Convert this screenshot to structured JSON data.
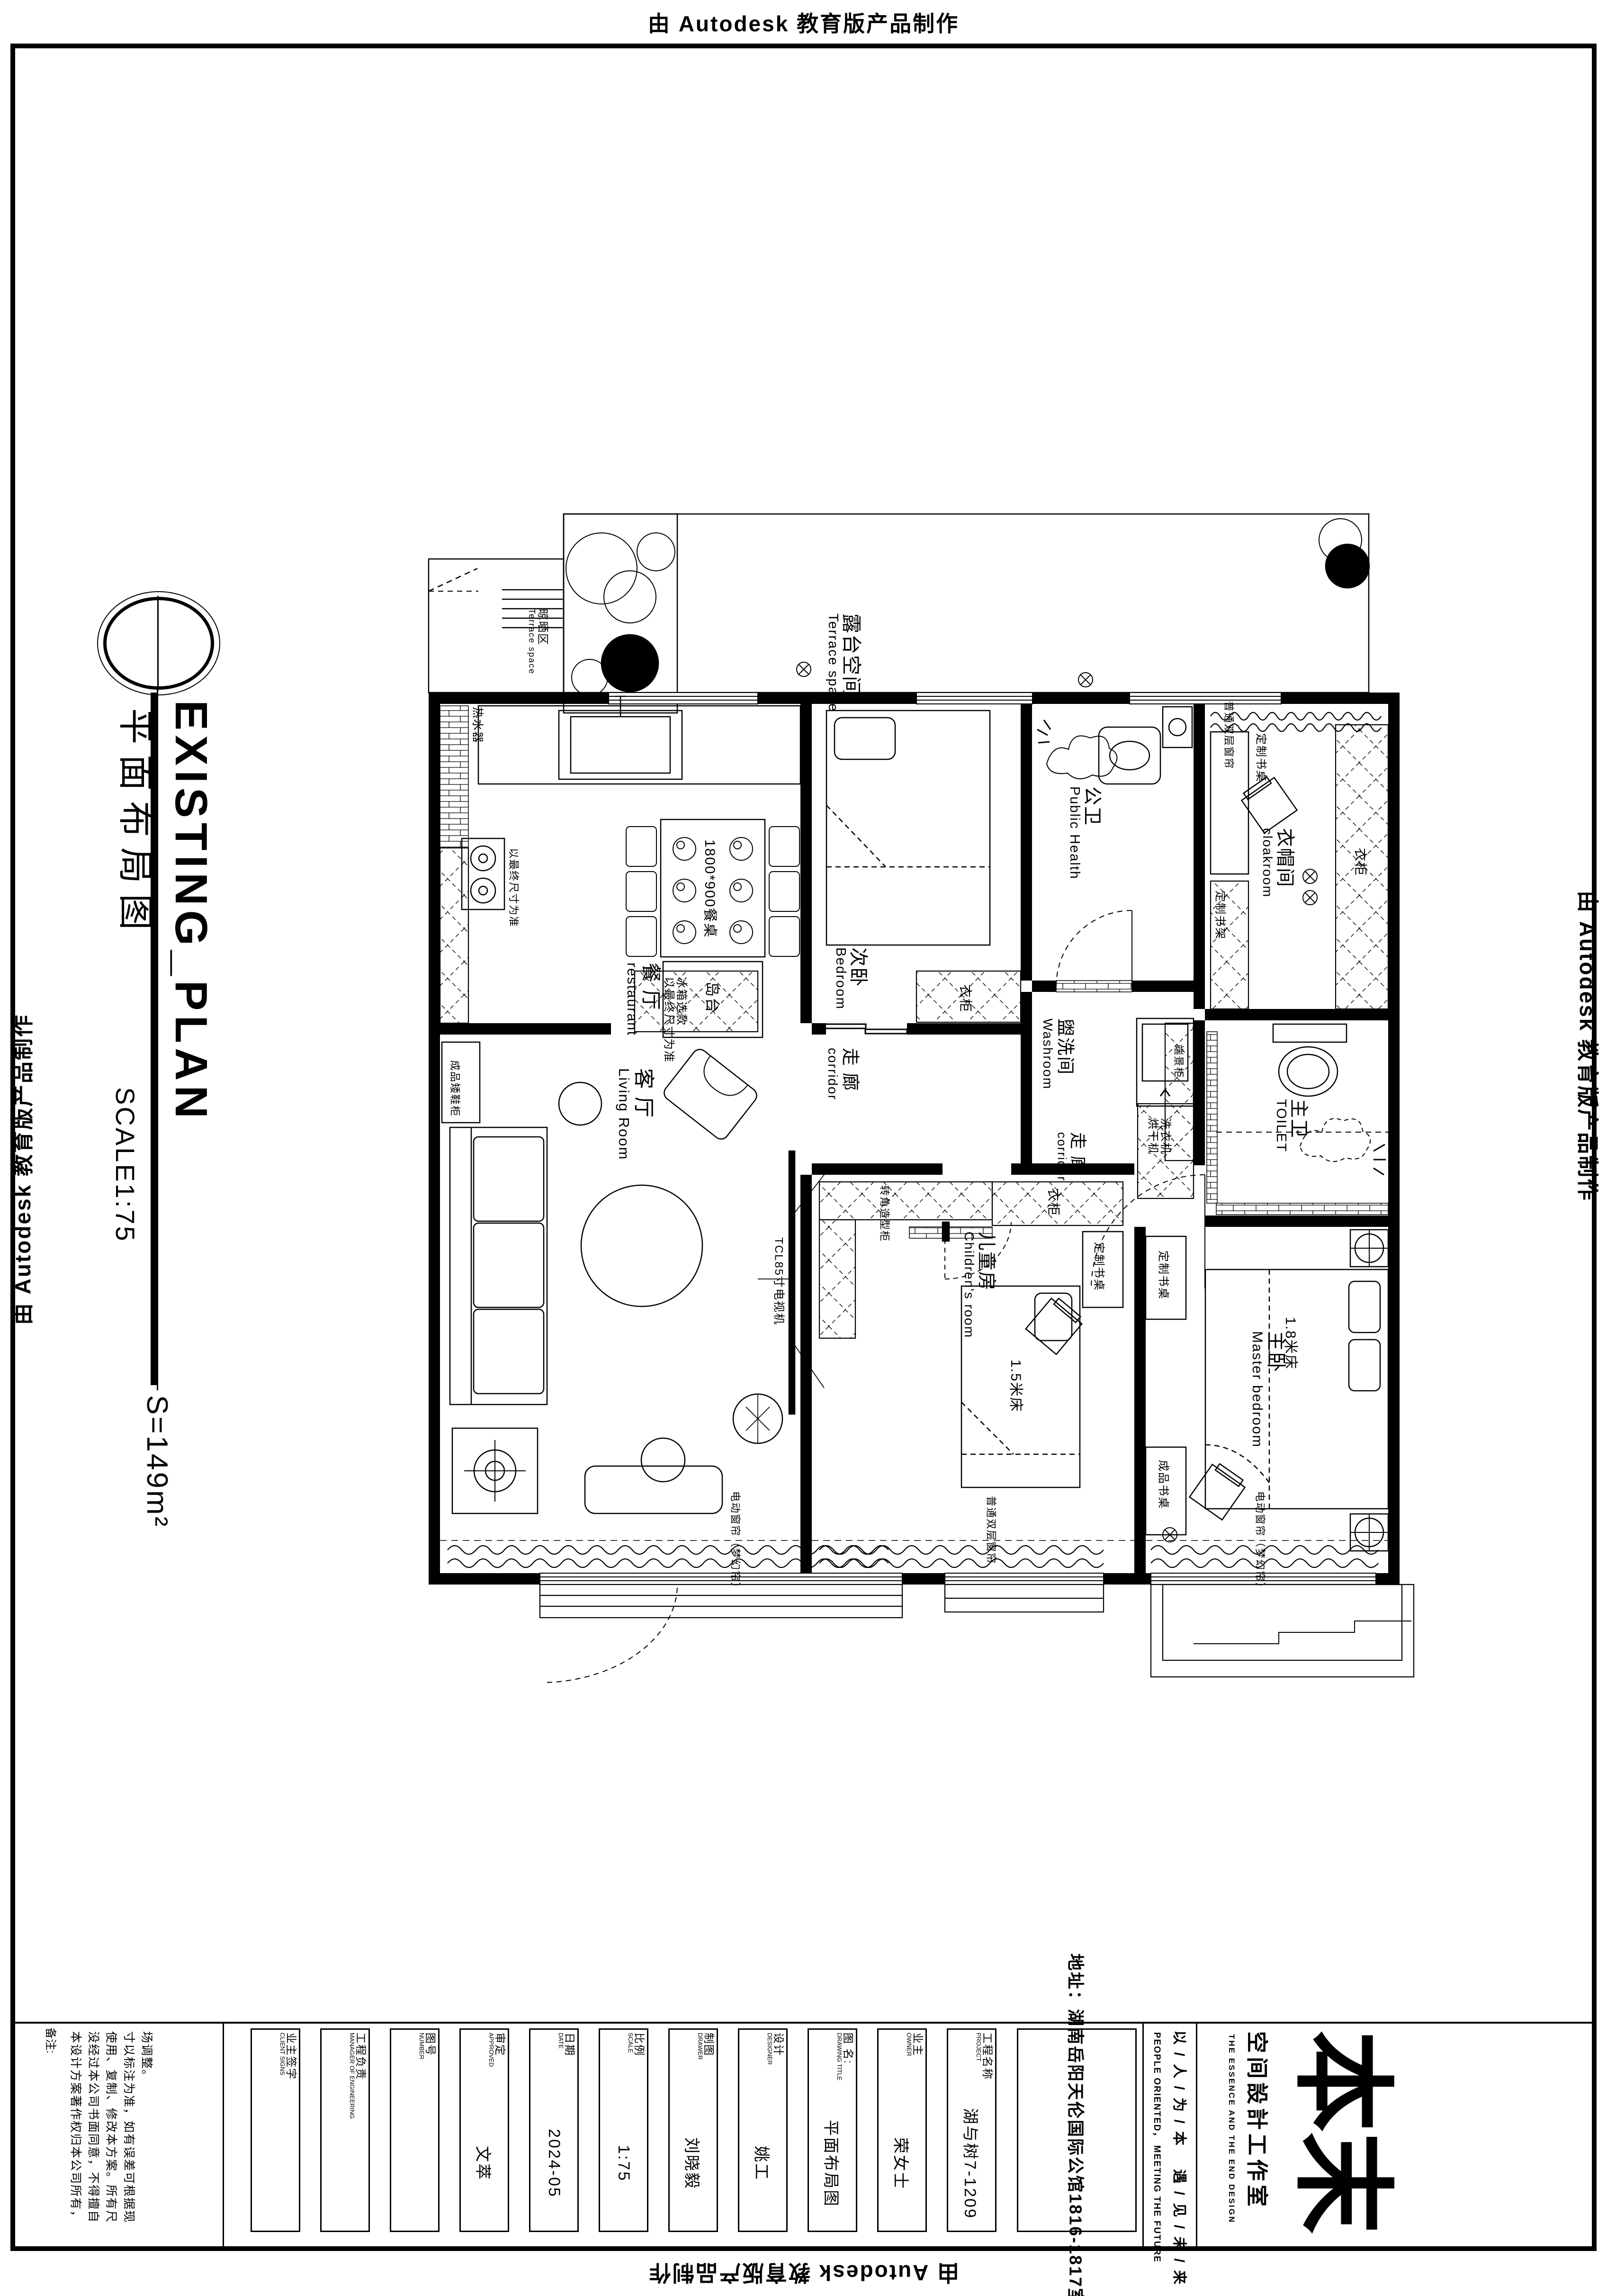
{
  "stamps": {
    "autodesk": "由 Autodesk 教育版产品制作"
  },
  "title": {
    "en": "EXISTING_PLAN",
    "zh": "平面布局图",
    "scale": "SCALE1:75",
    "area": "S=149m²"
  },
  "plan": {
    "terrace": {
      "zh": "露台空间",
      "en": "Terrace space"
    },
    "drying": {
      "zh": "晾晒区",
      "en": "Terrace space"
    },
    "dining": {
      "zh": "餐 厅",
      "en": "restaurant"
    },
    "living": {
      "zh": "客 厅",
      "en": "Living Room"
    },
    "bedroom2": {
      "zh": "次卧",
      "en": "Bedroom"
    },
    "children": {
      "zh": "儿童房",
      "en": "Children's room"
    },
    "master": {
      "zh": "主卧",
      "en": "Master bedroom"
    },
    "public_bath": {
      "zh": "公卫",
      "en": "Public Health"
    },
    "washroom": {
      "zh": "盥洗间",
      "en": "Washroom"
    },
    "master_bath": {
      "zh": "主卫",
      "en": "TOILET"
    },
    "cloakroom": {
      "zh": "衣帽间",
      "en": "cloakroom"
    },
    "corridor": {
      "zh": "走 廊",
      "en": "corridor"
    },
    "items": {
      "table": "1800*900餐桌",
      "island": "岛台",
      "fridge1": "冰箱选款",
      "fridge2": "以最终尺寸为准",
      "stove_note": "以最终尺寸为准",
      "water_heater": "热水器",
      "wardrobe": "衣柜",
      "washer1": "洗衣机",
      "washer2": "烘干机",
      "custom_desk": "定制书桌",
      "custom_shelf": "定制书架",
      "ready_desk": "成品书桌",
      "end_cabinet": "端景柜",
      "corner_cabinet": "转角造型柜",
      "shoe_cabinet": "成品矮鞋柜",
      "tv": "TCL85寸电视机",
      "bed18": "1.8米床",
      "bed15": "1.5米床",
      "curtain_plain": "普通双层窗帘",
      "curtain_electric": "电动窗帘（梦幻帘）"
    }
  },
  "titleblock": {
    "notes_label": "备注:",
    "notes": "本设计方案著作权归本公司所有，没经过本公司书面同意，不得擅自使用、复制、修改本方案。所有尺寸以标注为准，如有误差可根据现场调整。",
    "fields": [
      {
        "label_zh": "业主签字",
        "label_en": "CLIENT SIGNS",
        "value": ""
      },
      {
        "label_zh": "工程负责",
        "label_en": "MANAGER OF ENGINEERING",
        "value": ""
      },
      {
        "label_zh": "图号",
        "label_en": "NUMBER",
        "value": ""
      },
      {
        "label_zh": "审定",
        "label_en": "APPROVED",
        "value": "文萃"
      },
      {
        "label_zh": "日期",
        "label_en": "DATE",
        "value": "2024-05"
      },
      {
        "label_zh": "比例",
        "label_en": "SCALE",
        "value": "1:75"
      },
      {
        "label_zh": "制图",
        "label_en": "DRAWER",
        "value": "刘晓毅"
      },
      {
        "label_zh": "设计",
        "label_en": "DESIGNER",
        "value": "姚工"
      },
      {
        "label_zh": "图 名:",
        "label_en": "DRAWING TITLE",
        "value": "平面布局图"
      },
      {
        "label_zh": "业主",
        "label_en": "OWNER",
        "value": "荣女士"
      },
      {
        "label_zh": "工程名称",
        "label_en": "PROJECT",
        "value": "湖与树7-1209"
      }
    ],
    "address_label": "地址：",
    "address": "湖南岳阳天伦国际公馆1816-1817室",
    "slogan_zh": "以 / 人 / 为 / 本　 遇 / 见 / 未 / 来",
    "slogan_en": "PEOPLE ORIENTED， MEETING THE FUTURE",
    "logo": {
      "glyph": "本末",
      "studio": "空间設計工作室",
      "tagline": "THE ESSENCE AND THE END DESIGN"
    }
  }
}
